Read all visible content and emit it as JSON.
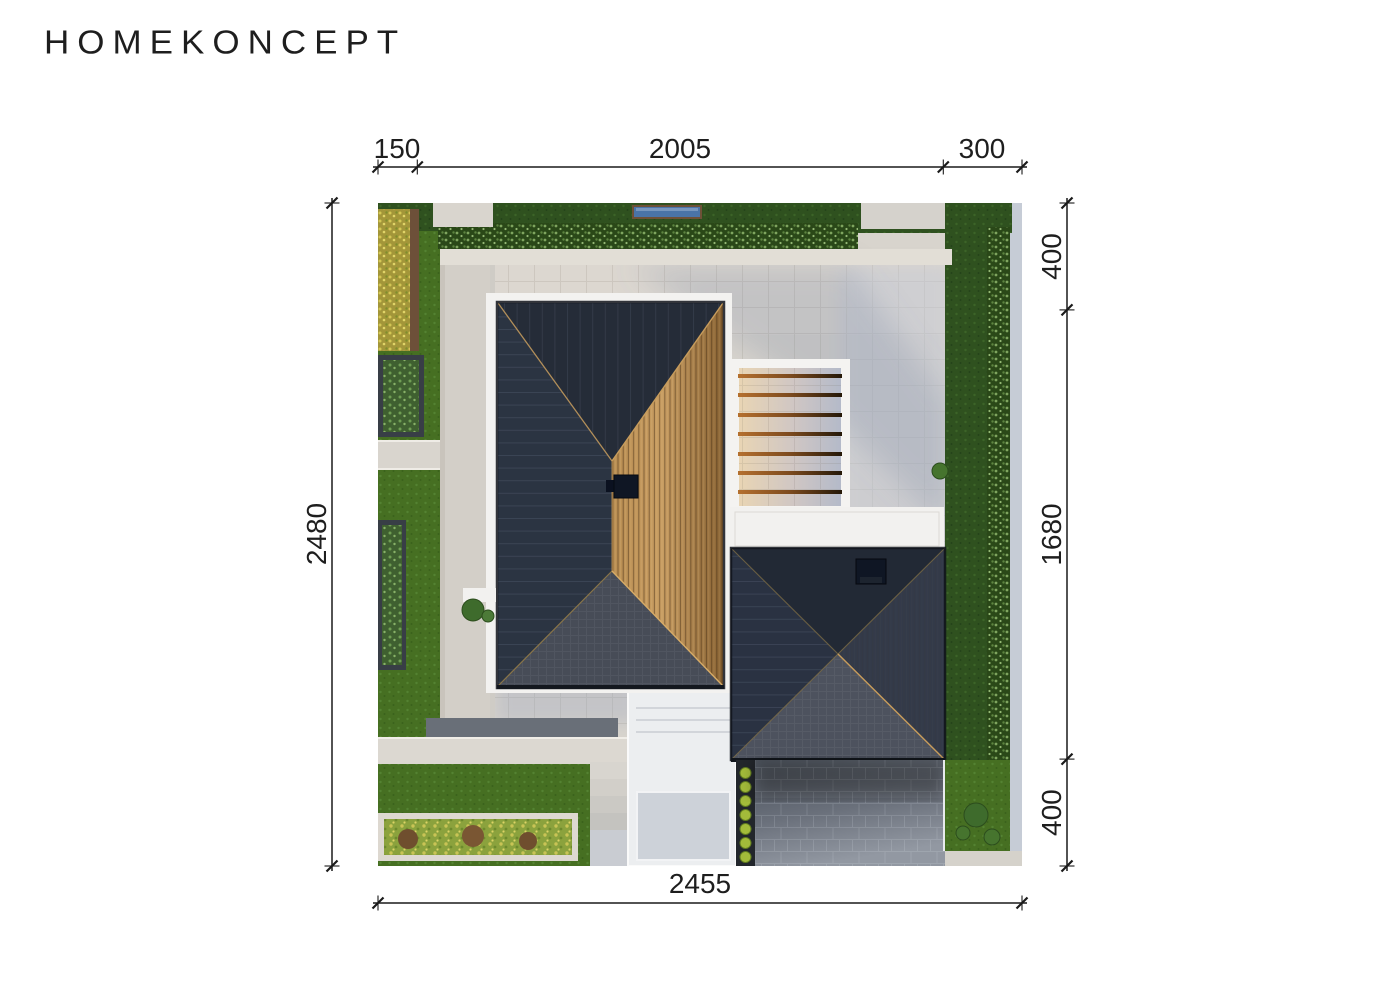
{
  "logo": {
    "text": "HOMEKONCEPT"
  },
  "dimensions": {
    "top": {
      "labels": [
        "150",
        "2005",
        "300"
      ]
    },
    "right": {
      "labels": [
        "400",
        "1680",
        "400"
      ]
    },
    "left": {
      "label": "2480"
    },
    "bottom": {
      "label": "2455"
    }
  },
  "site_plan": {
    "type": "aerial-roof-plan-render",
    "elements": [
      "main-house-roof",
      "wood-clad-roof-section",
      "roof-chimney",
      "pergola-with-beams",
      "flat-roof",
      "garage-pyramid-roof",
      "garage-chimney",
      "driveway",
      "walkway",
      "terrace",
      "lawns",
      "hedges",
      "planters",
      "garden-bed",
      "pool"
    ]
  },
  "palette": {
    "ink": "#1e1e1e",
    "paper": "#ffffff",
    "pavement": "#d8d4cd",
    "pavement-cool": "#c3c8d4",
    "gravel": "#e2ded6",
    "lawn": "#466f22",
    "lawn-dark": "#2f511f",
    "white-structure": "#f3f2f0",
    "roof-north": "#252c38",
    "roof-west": "#2b3442",
    "roof-south": "#474c57",
    "roof-wood": "#c59a5e",
    "ridge-amber": "#c79c5c",
    "garage-north": "#222935",
    "garage-west": "#2a3242",
    "garage-east": "#333a49",
    "garage-south": "#4d525e",
    "driveway": "#5a616b",
    "walkway": "#eceef0",
    "planter-soil": "#22262b",
    "plant-yellow": "#a3bb3a",
    "pool-blue": "#4a74a8",
    "bush-green": "#3e6b2c",
    "chimney": "#0f1624"
  }
}
